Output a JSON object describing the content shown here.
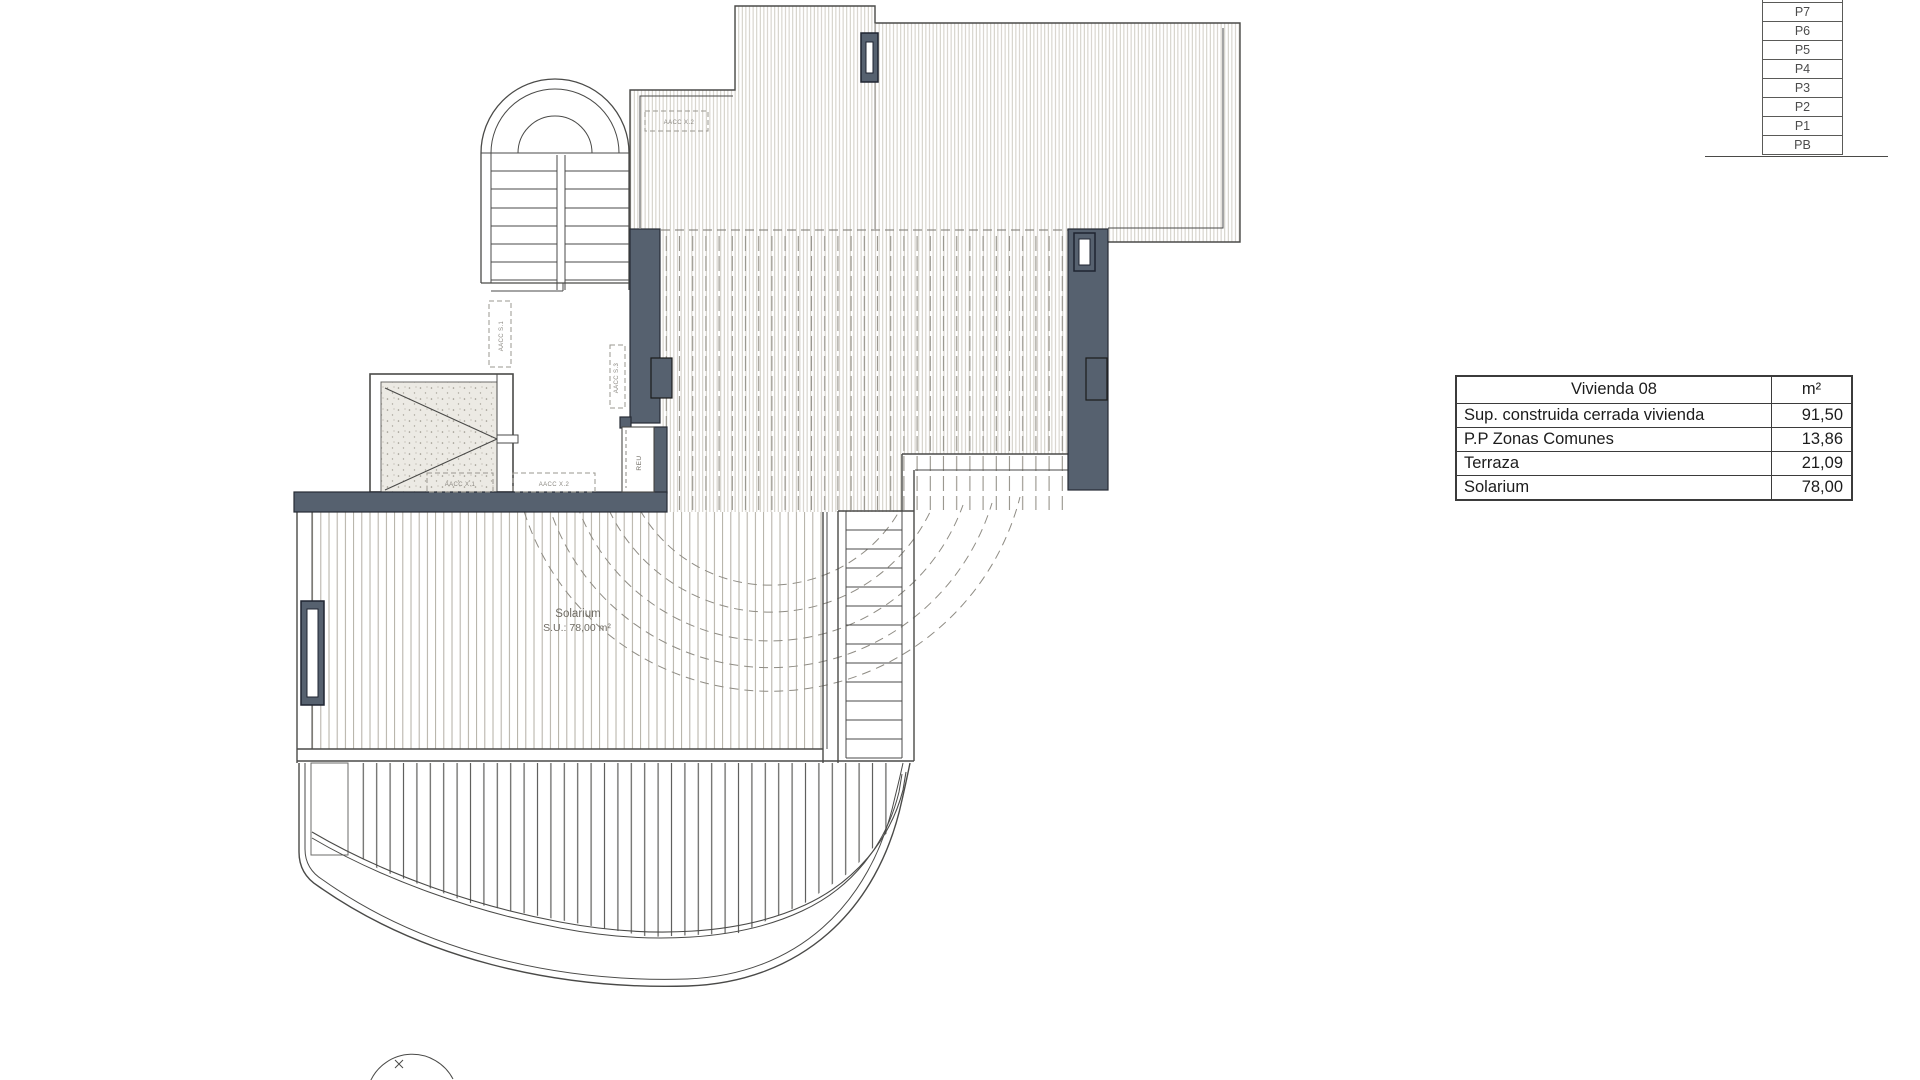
{
  "level_stack": {
    "floors": [
      "P7",
      "P6",
      "P5",
      "P4",
      "P3",
      "P2",
      "P1",
      "PB"
    ]
  },
  "area_table": {
    "title": "Vivienda 08",
    "unit_header": "m²",
    "rows": [
      {
        "label": "Sup. construida cerrada vivienda",
        "value": "91,50"
      },
      {
        "label": "P.P Zonas Comunes",
        "value": "13,86"
      },
      {
        "label": "Terraza",
        "value": "21,09"
      },
      {
        "label": "Solarium",
        "value": "78,00"
      }
    ]
  },
  "plan": {
    "solarium_label": "Solarium",
    "solarium_area": "S.U.: 78,00 m²",
    "labels": {
      "aacc_roof": "AACC X.2",
      "aacc_s1": "AACC S.1",
      "aacc_s3": "AACC S.3",
      "aacc_x1": "AACC X.1",
      "aacc_x2": "AACC X.2",
      "reu": "REU"
    },
    "colors": {
      "wall_fill": "#56616f"
    }
  }
}
